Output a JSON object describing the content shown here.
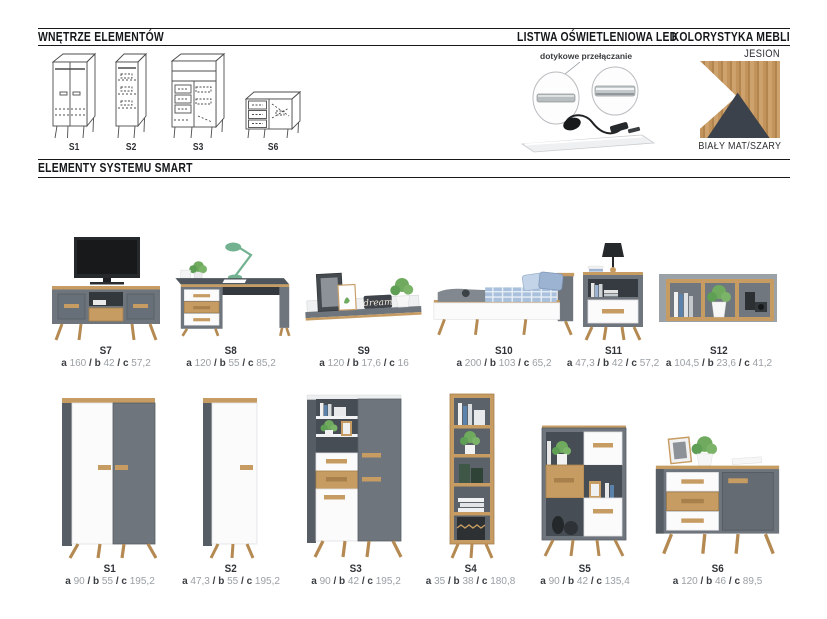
{
  "header": {
    "interiors_title": "WNĘTRZE ELEMENTÓW",
    "led_title": "LISTWA OŚWIETLENIOWA LED",
    "colors_title": "KOLORYSTYKA MEBLI",
    "led_caption": "dotykowe przełączanie",
    "color_top_label": "JESION",
    "color_bottom_label": "BIAŁY MAT/SZARY"
  },
  "section_title": "ELEMENTY SYSTEMU SMART",
  "interiors": {
    "items": [
      {
        "id": "S1"
      },
      {
        "id": "S2"
      },
      {
        "id": "S3"
      },
      {
        "id": "S6"
      }
    ]
  },
  "labels": {
    "a": "a",
    "b": "b",
    "c": "c",
    "sep": "/"
  },
  "colors": {
    "wood": "#c2945c",
    "white": "#ffffff",
    "dark": "#3b424b",
    "gray": "#6e757c"
  },
  "products": {
    "row1": [
      {
        "id": "S7",
        "type": "tv-stand",
        "dims": {
          "a": "160",
          "b": "42",
          "c": "57,2"
        }
      },
      {
        "id": "S8",
        "type": "desk",
        "dims": {
          "a": "120",
          "b": "55",
          "c": "85,2"
        }
      },
      {
        "id": "S9",
        "type": "wall-shelf",
        "dims": {
          "a": "120",
          "b": "17,6",
          "c": "16"
        },
        "sign": "dream"
      },
      {
        "id": "S10",
        "type": "bed",
        "dims": {
          "a": "200",
          "b": "103",
          "c": "65,2"
        }
      },
      {
        "id": "S11",
        "type": "nightstand",
        "dims": {
          "a": "47,3",
          "b": "42",
          "c": "57,2"
        }
      },
      {
        "id": "S12",
        "type": "wall-cube-shelf",
        "dims": {
          "a": "104,5",
          "b": "23,6",
          "c": "41,2"
        }
      }
    ],
    "row2": [
      {
        "id": "S1",
        "type": "wardrobe-2-door",
        "dims": {
          "a": "90",
          "b": "55",
          "c": "195,2"
        }
      },
      {
        "id": "S2",
        "type": "wardrobe-1-door",
        "dims": {
          "a": "47,3",
          "b": "55",
          "c": "195,2"
        }
      },
      {
        "id": "S3",
        "type": "tall-cabinet",
        "dims": {
          "a": "90",
          "b": "42",
          "c": "195,2"
        }
      },
      {
        "id": "S4",
        "type": "open-bookcase",
        "dims": {
          "a": "35",
          "b": "38",
          "c": "180,8"
        }
      },
      {
        "id": "S5",
        "type": "low-bookcase",
        "dims": {
          "a": "90",
          "b": "42",
          "c": "135,4"
        }
      },
      {
        "id": "S6",
        "type": "sideboard",
        "dims": {
          "a": "120",
          "b": "46",
          "c": "89,5"
        }
      }
    ]
  }
}
